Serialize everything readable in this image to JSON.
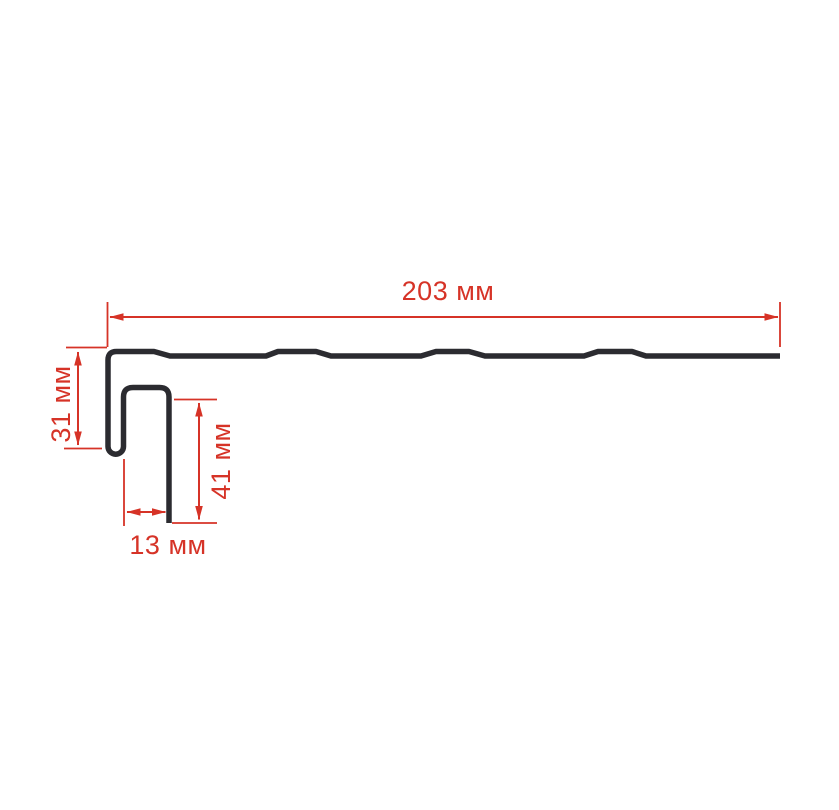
{
  "page": {
    "background": "#ffffff",
    "description": "Technical dimension drawing of a J-trim profile cross-section"
  },
  "drawing": {
    "profile_name": "j-profile-cross-section",
    "units": "мм",
    "profile_stroke_color": "#2b2b30",
    "dimension_color": "#d63327",
    "dimensions": {
      "total_width": {
        "value": "203",
        "unit": "мм",
        "label": "203 мм"
      },
      "left_hook_height": {
        "value": "31",
        "unit": "мм",
        "label": "31 мм"
      },
      "leg_height": {
        "value": "41",
        "unit": "мм",
        "label": "41 мм"
      },
      "channel_width": {
        "value": "13",
        "unit": "мм",
        "label": "13 мм"
      }
    }
  }
}
